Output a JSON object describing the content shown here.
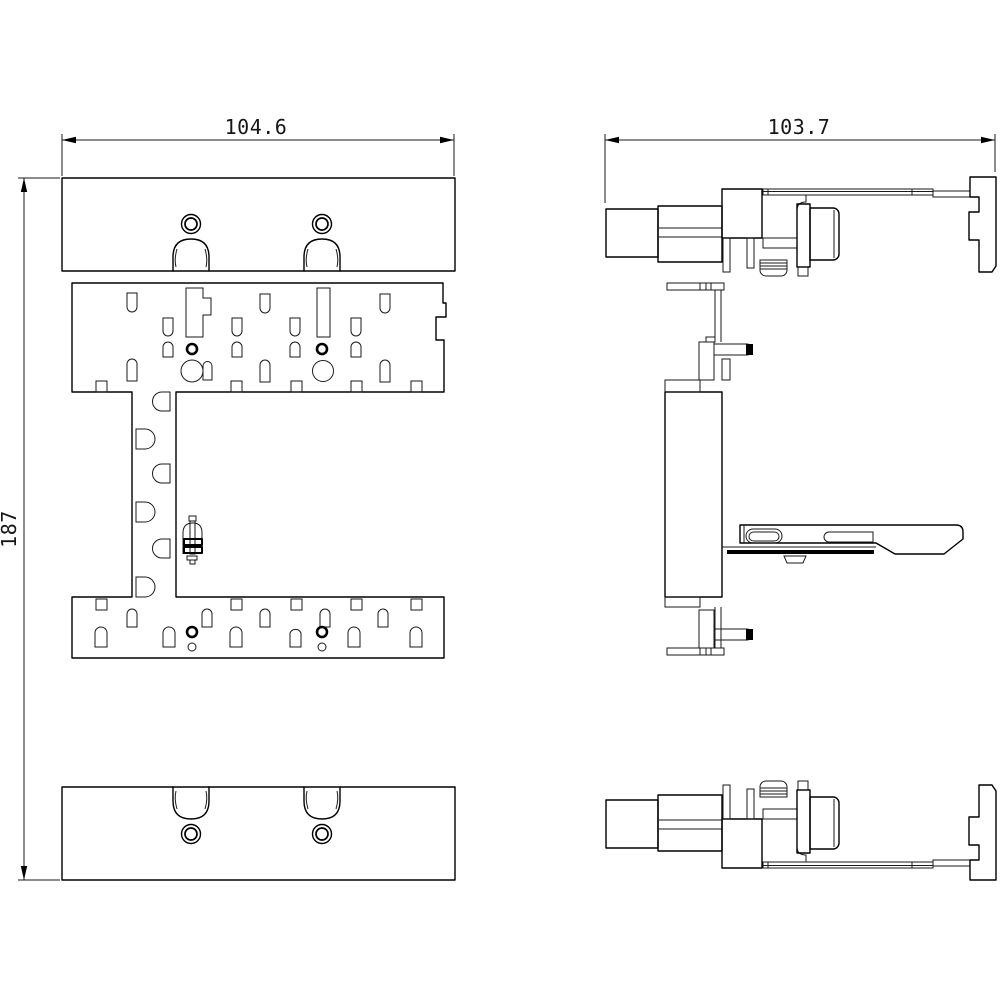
{
  "drawing": {
    "type": "cad-dimension-drawing",
    "dim_front_width": "104.6",
    "dim_side_width": "103.7",
    "dim_height": "187",
    "line_color": "#000000",
    "background_color": "#ffffff",
    "views": {
      "front_view": "front view of mounting plates and slotted center plate",
      "side_view": "side profile view with DIN-rail clip"
    }
  }
}
